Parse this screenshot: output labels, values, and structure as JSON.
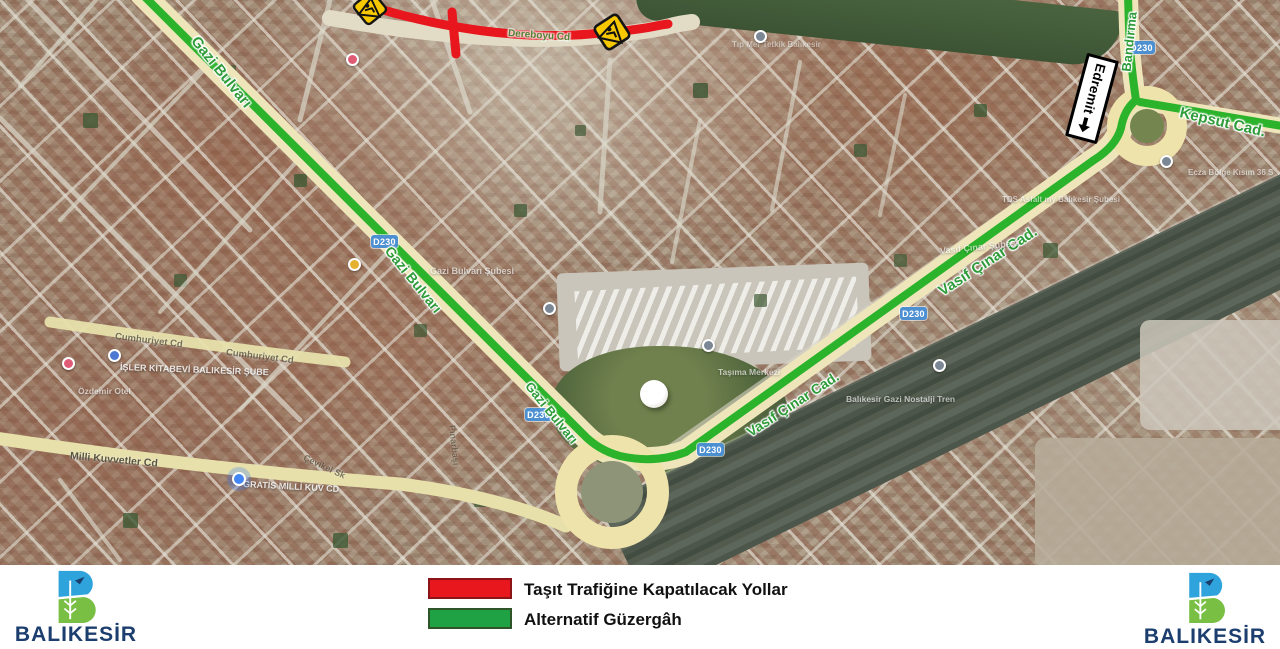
{
  "legend": {
    "items": [
      {
        "swatch_color": "#e8161d",
        "label": "Taşıt Trafiğine Kapatılacak Yollar"
      },
      {
        "swatch_color": "#1fa244",
        "label": "Alternatif Güzergâh"
      }
    ]
  },
  "footer": {
    "municipality": "BALIKESİR"
  },
  "map": {
    "route_colors": {
      "closed": "#e8161d",
      "alternative": "#2bb32b"
    },
    "shield": "D230",
    "direction_sign": "Edremit",
    "road_labels": {
      "gazi_bulvari_1": "Gazi Bulvarı",
      "gazi_bulvari_2": "Gazi Bulvarı",
      "gazi_bulvari_3": "Gazi Bulvarı",
      "vasif_cinar_1": "Vasıf Çınar Cad.",
      "vasif_cinar_2": "Vasıf Çınar Cad.",
      "bandirma": "Bandırma",
      "kepsut": "Kepsut Cad.",
      "dereboyu": "Dereboyu Cd",
      "milli_kuvvetler": "Milli Kuvvetler Cd",
      "cumhuriyet_1": "Cumhuriyet Cd",
      "cumhuriyet_2": "Cumhuriyet Cd",
      "cevikel": "Çevikel Sk",
      "pinarbasi": "Pınarbaşı"
    },
    "poi_labels": {
      "isler_kitabevi": "İŞLER KİTABEVİ BALIKESİR ŞUBE",
      "gratis": "GRATİS MİLLİ KUV CD",
      "ozdemir_otel": "Özdemir Otel",
      "gazi_subesi": "Gazi Bulvarı Şubesi",
      "vasif_subesi": "Vasıf Çınar Şubesi",
      "nostalji": "Balıkesir Gazi Nostalji Tren",
      "tasima": "Taşıma Merkezi",
      "ecza": "Ecza Bölge Kısım 36 S",
      "tds": "TDS Asfalt my Balıkesir Şubesi",
      "tip": "Tıp Mer Tetkik Balıkesir"
    }
  }
}
